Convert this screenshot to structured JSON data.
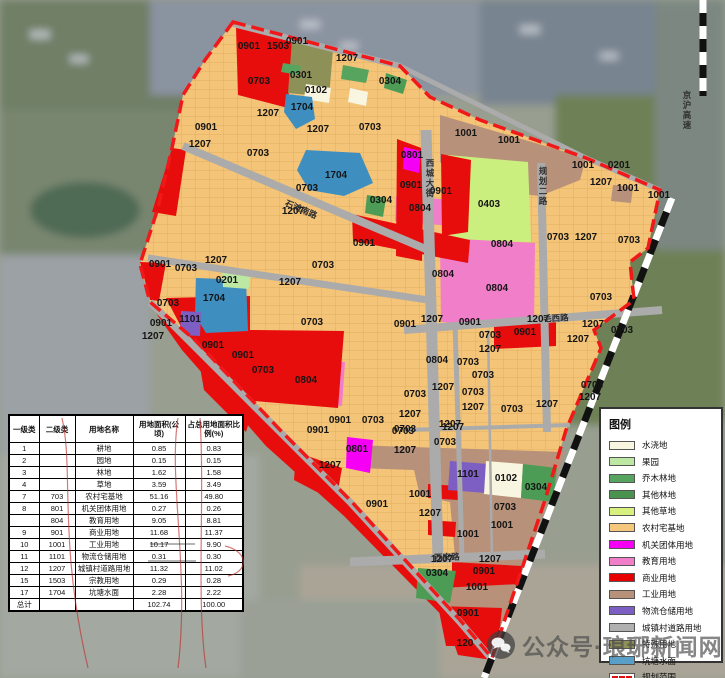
{
  "map": {
    "palette": {
      "0703": "#F4C478",
      "0901": "#E80D0D",
      "0804": "#F07EC8",
      "0801": "#F500F5",
      "1001": "#B7917A",
      "1101": "#7D5FC4",
      "1704": "#3E8FC0",
      "0403": "#CBEF7E",
      "0304": "#4D9C55",
      "0301": "#57A45F",
      "1503": "#8D9158",
      "0102": "#F8F5E0",
      "0201": "#BCE8A4",
      "1207": "#ABABAB"
    },
    "boundary_color": "#F01818",
    "labels": [
      {
        "t": "0901",
        "x": 249,
        "y": 49
      },
      {
        "t": "1503",
        "x": 278,
        "y": 49
      },
      {
        "t": "0901",
        "x": 297,
        "y": 44
      },
      {
        "t": "1207",
        "x": 347,
        "y": 61
      },
      {
        "t": "0703",
        "x": 259,
        "y": 84
      },
      {
        "t": "0301",
        "x": 301,
        "y": 78
      },
      {
        "t": "0102",
        "x": 316,
        "y": 93
      },
      {
        "t": "1704",
        "x": 302,
        "y": 110
      },
      {
        "t": "1207",
        "x": 268,
        "y": 116
      },
      {
        "t": "1207",
        "x": 318,
        "y": 132
      },
      {
        "t": "0703",
        "x": 370,
        "y": 130
      },
      {
        "t": "0304",
        "x": 390,
        "y": 84
      },
      {
        "t": "0901",
        "x": 206,
        "y": 130
      },
      {
        "t": "1207",
        "x": 200,
        "y": 147
      },
      {
        "t": "0703",
        "x": 258,
        "y": 156
      },
      {
        "t": "1704",
        "x": 336,
        "y": 178
      },
      {
        "t": "0703",
        "x": 307,
        "y": 191
      },
      {
        "t": "1207",
        "x": 293,
        "y": 214
      },
      {
        "t": "0304",
        "x": 381,
        "y": 203
      },
      {
        "t": "0804",
        "x": 420,
        "y": 211
      },
      {
        "t": "0901",
        "x": 411,
        "y": 188
      },
      {
        "t": "0901",
        "x": 441,
        "y": 194
      },
      {
        "t": "0901",
        "x": 364,
        "y": 246
      },
      {
        "t": "0801",
        "x": 412,
        "y": 158
      },
      {
        "t": "1001",
        "x": 466,
        "y": 136
      },
      {
        "t": "1001",
        "x": 509,
        "y": 143
      },
      {
        "t": "0403",
        "x": 489,
        "y": 207
      },
      {
        "t": "0804",
        "x": 502,
        "y": 247
      },
      {
        "t": "0804",
        "x": 443,
        "y": 277
      },
      {
        "t": "0804",
        "x": 497,
        "y": 291
      },
      {
        "t": "1001",
        "x": 583,
        "y": 168
      },
      {
        "t": "0201",
        "x": 619,
        "y": 168
      },
      {
        "t": "1207",
        "x": 601,
        "y": 185
      },
      {
        "t": "1001",
        "x": 628,
        "y": 191
      },
      {
        "t": "1001",
        "x": 659,
        "y": 198
      },
      {
        "t": "0703",
        "x": 558,
        "y": 240
      },
      {
        "t": "1207",
        "x": 586,
        "y": 240
      },
      {
        "t": "0703",
        "x": 629,
        "y": 243
      },
      {
        "t": "0703",
        "x": 601,
        "y": 300
      },
      {
        "t": "0901",
        "x": 160,
        "y": 267
      },
      {
        "t": "0703",
        "x": 186,
        "y": 271
      },
      {
        "t": "1207",
        "x": 216,
        "y": 263
      },
      {
        "t": "0201",
        "x": 227,
        "y": 283
      },
      {
        "t": "1704",
        "x": 214,
        "y": 301
      },
      {
        "t": "0703",
        "x": 168,
        "y": 306
      },
      {
        "t": "1101",
        "x": 190,
        "y": 322
      },
      {
        "t": "0901",
        "x": 161,
        "y": 326
      },
      {
        "t": "1207",
        "x": 153,
        "y": 339
      },
      {
        "t": "0901",
        "x": 213,
        "y": 348
      },
      {
        "t": "0901",
        "x": 243,
        "y": 358
      },
      {
        "t": "0703",
        "x": 263,
        "y": 373
      },
      {
        "t": "0804",
        "x": 306,
        "y": 383
      },
      {
        "t": "1207",
        "x": 290,
        "y": 285
      },
      {
        "t": "0703",
        "x": 323,
        "y": 268
      },
      {
        "t": "0703",
        "x": 312,
        "y": 325
      },
      {
        "t": "0901",
        "x": 405,
        "y": 327
      },
      {
        "t": "1207",
        "x": 432,
        "y": 322
      },
      {
        "t": "0901",
        "x": 470,
        "y": 325
      },
      {
        "t": "1207",
        "x": 538,
        "y": 322
      },
      {
        "t": "1207",
        "x": 593,
        "y": 327
      },
      {
        "t": "0703",
        "x": 622,
        "y": 333
      },
      {
        "t": "0901",
        "x": 525,
        "y": 335
      },
      {
        "t": "1207",
        "x": 578,
        "y": 342
      },
      {
        "t": "0703",
        "x": 490,
        "y": 338
      },
      {
        "t": "1207",
        "x": 490,
        "y": 352
      },
      {
        "t": "0804",
        "x": 437,
        "y": 363
      },
      {
        "t": "0703",
        "x": 468,
        "y": 365
      },
      {
        "t": "0703",
        "x": 483,
        "y": 378
      },
      {
        "t": "1207",
        "x": 443,
        "y": 390
      },
      {
        "t": "0703",
        "x": 415,
        "y": 397
      },
      {
        "t": "0703",
        "x": 473,
        "y": 395
      },
      {
        "t": "1207",
        "x": 473,
        "y": 410
      },
      {
        "t": "0703",
        "x": 512,
        "y": 412
      },
      {
        "t": "1207",
        "x": 547,
        "y": 407
      },
      {
        "t": "0703",
        "x": 592,
        "y": 388
      },
      {
        "t": "1207",
        "x": 590,
        "y": 400
      },
      {
        "t": "1207",
        "x": 410,
        "y": 417
      },
      {
        "t": "0703",
        "x": 405,
        "y": 432
      },
      {
        "t": "1207",
        "x": 450,
        "y": 427
      },
      {
        "t": "0703",
        "x": 445,
        "y": 445
      },
      {
        "t": "1207",
        "x": 405,
        "y": 453
      },
      {
        "t": "0901",
        "x": 340,
        "y": 423
      },
      {
        "t": "0703",
        "x": 373,
        "y": 423
      },
      {
        "t": "0703",
        "x": 403,
        "y": 434
      },
      {
        "t": "1207",
        "x": 453,
        "y": 430
      },
      {
        "t": "0801",
        "x": 357,
        "y": 452
      },
      {
        "t": "1207",
        "x": 330,
        "y": 468
      },
      {
        "t": "0901",
        "x": 318,
        "y": 433
      },
      {
        "t": "1101",
        "x": 468,
        "y": 477
      },
      {
        "t": "0102",
        "x": 506,
        "y": 481
      },
      {
        "t": "0304",
        "x": 536,
        "y": 490
      },
      {
        "t": "1001",
        "x": 420,
        "y": 497
      },
      {
        "t": "0901",
        "x": 377,
        "y": 507
      },
      {
        "t": "1207",
        "x": 430,
        "y": 516
      },
      {
        "t": "0703",
        "x": 505,
        "y": 510
      },
      {
        "t": "1001",
        "x": 502,
        "y": 528
      },
      {
        "t": "1001",
        "x": 468,
        "y": 537
      },
      {
        "t": "1207",
        "x": 442,
        "y": 562
      },
      {
        "t": "1207",
        "x": 490,
        "y": 562
      },
      {
        "t": "0304",
        "x": 437,
        "y": 576
      },
      {
        "t": "0901",
        "x": 484,
        "y": 574
      },
      {
        "t": "1001",
        "x": 477,
        "y": 590
      },
      {
        "t": "0901",
        "x": 468,
        "y": 616
      },
      {
        "t": "120",
        "x": 465,
        "y": 646
      }
    ],
    "road_names": [
      {
        "t": "西城大街",
        "x": 430,
        "y": 166,
        "mode": "v"
      },
      {
        "t": "规划二路",
        "x": 543,
        "y": 174,
        "mode": "v"
      },
      {
        "t": "京沪高速",
        "x": 687,
        "y": 98,
        "mode": "v"
      },
      {
        "t": "石滩南路",
        "x": 300,
        "y": 212,
        "rot": 23
      },
      {
        "t": "毛西路",
        "x": 556,
        "y": 321,
        "rot": -3
      },
      {
        "t": "西安路",
        "x": 447,
        "y": 560,
        "rot": -2
      }
    ]
  },
  "table": {
    "headers": [
      "一级类",
      "二级类",
      "用地名称",
      "用地面积(公顷)",
      "占总用地面积比例(%)"
    ],
    "rows": [
      [
        "1",
        "",
        "耕地",
        "0.85",
        "0.83"
      ],
      [
        "2",
        "",
        "园地",
        "0.15",
        "0.15"
      ],
      [
        "3",
        "",
        "林地",
        "1.62",
        "1.58"
      ],
      [
        "4",
        "",
        "草地",
        "3.59",
        "3.49"
      ],
      [
        "7",
        "703",
        "农村宅基地",
        "51.16",
        "49.80"
      ],
      [
        "8",
        "801",
        "机关团体用地",
        "0.27",
        "0.26"
      ],
      [
        "",
        "804",
        "教育用地",
        "9.05",
        "8.81"
      ],
      [
        "9",
        "901",
        "商业用地",
        "11.68",
        "11.37"
      ],
      [
        "10",
        "1001",
        "工业用地",
        "10.17",
        "9.90"
      ],
      [
        "11",
        "1101",
        "物流仓储用地",
        "0.31",
        "0.30"
      ],
      [
        "12",
        "1207",
        "城镇村道路用地",
        "11.32",
        "11.02"
      ],
      [
        "15",
        "1503",
        "宗教用地",
        "0.29",
        "0.28"
      ],
      [
        "17",
        "1704",
        "坑塘水面",
        "2.28",
        "2.22"
      ],
      [
        "总计",
        "",
        "",
        "102.74",
        "100.00"
      ]
    ]
  },
  "legend": {
    "title": "图例",
    "items": [
      {
        "label": "水浇地",
        "color": "#F8F5E0"
      },
      {
        "label": "果园",
        "color": "#BCE8A4"
      },
      {
        "label": "乔木林地",
        "color": "#57A45F"
      },
      {
        "label": "其他林地",
        "color": "#49934F"
      },
      {
        "label": "其他草地",
        "color": "#D8F17E"
      },
      {
        "label": "农村宅基地",
        "color": "#F6C87E"
      },
      {
        "label": "机关团体用地",
        "color": "#F500F5"
      },
      {
        "label": "教育用地",
        "color": "#F07EC8"
      },
      {
        "label": "商业用地",
        "color": "#E80000"
      },
      {
        "label": "工业用地",
        "color": "#B7917A"
      },
      {
        "label": "物流仓储用地",
        "color": "#7D5FC4"
      },
      {
        "label": "城镇村道路用地",
        "color": "#B0B0B0"
      },
      {
        "label": "特殊用地",
        "color": "#8D9158"
      },
      {
        "label": "坑塘水面",
        "color": "#58A0C8"
      },
      {
        "label": "规划范围",
        "color": "#FFFFFF",
        "type": "dash"
      }
    ]
  },
  "watermark": {
    "text": "公众号·琅琊新闻网",
    "icon": "wechat-icon"
  }
}
